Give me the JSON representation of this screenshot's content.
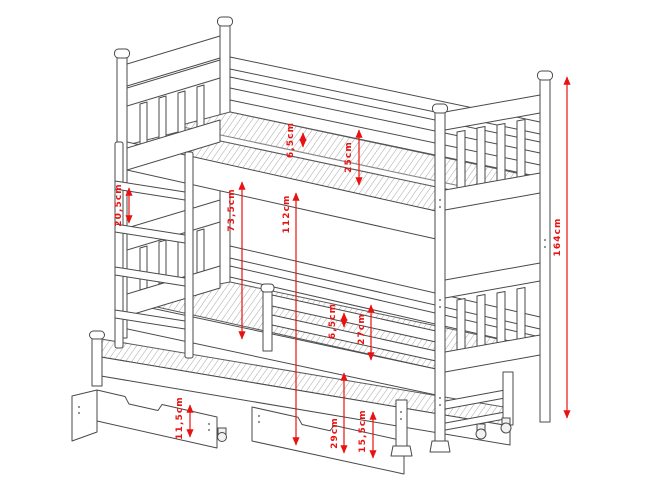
{
  "diagram": {
    "type": "technical-drawing",
    "subject": "bunk bed with trundle bed and storage drawers",
    "unit": "cm",
    "colors": {
      "background": "#ffffff",
      "line": "#4a4a4a",
      "dimension": "#e91212"
    },
    "dimensions": [
      {
        "id": "top-bunk-slat-thickness",
        "label": "6,5cm",
        "value": "6,5"
      },
      {
        "id": "top-bunk-guard-height",
        "label": "25cm",
        "value": "25"
      },
      {
        "id": "ladder-rung-spacing",
        "label": "20,5cm",
        "value": "20,5"
      },
      {
        "id": "bunk-clearance",
        "label": "73,5cm",
        "value": "73,5"
      },
      {
        "id": "top-bunk-underside-height",
        "label": "112cm",
        "value": "112"
      },
      {
        "id": "overall-height",
        "label": "164cm",
        "value": "164"
      },
      {
        "id": "bottom-bunk-slat-thickness",
        "label": "6,5cm",
        "value": "6,5"
      },
      {
        "id": "bottom-bunk-guard-height",
        "label": "27cm",
        "value": "27"
      },
      {
        "id": "drawer-front-height",
        "label": "11,5cm",
        "value": "11,5"
      },
      {
        "id": "trundle-platform-height",
        "label": "29cm",
        "value": "29"
      },
      {
        "id": "trundle-frame-height",
        "label": "15,5cm",
        "value": "15,5"
      }
    ]
  }
}
